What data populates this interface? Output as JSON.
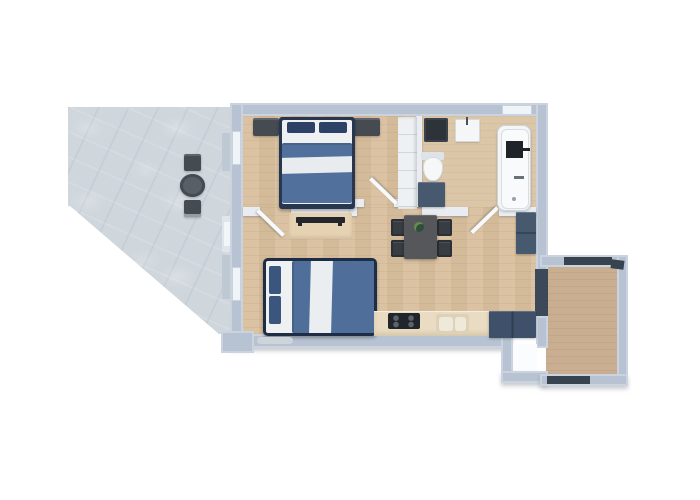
{
  "scene": {
    "kind": "3d-apartment-floor-plan",
    "background": "#ffffff",
    "visible_text": "none"
  },
  "palette": {
    "exterior_wall": "#b7c3d2",
    "interior_wall": "#e9edf1",
    "wood_floor": "#d8bf9e",
    "bathroom_floor": "#dcc6a8",
    "balcony_floor": "#c9ae92",
    "terrace_stone": "#cfd6dc",
    "bed_frame_navy": "#1f2d44",
    "duvet_blue": "#4f6f9a",
    "linen_white": "#eef0f2",
    "pillow_navy": "#2c4165",
    "dark_furniture": "#464b52",
    "blue_gray_cabinet": "#47596e",
    "appliance_dark": "#2e333a",
    "fixture_white": "#f4f6f8",
    "railing_dark": "#37434f"
  },
  "rooms": {
    "terrace": {
      "label": "Terrace with stone tiles"
    },
    "bedroom": {
      "label": "Bedroom with double bed"
    },
    "bathroom": {
      "label": "Bathroom"
    },
    "living": {
      "label": "Living room with bed, dining set and kitchen"
    },
    "balcony": {
      "label": "Balcony with wood deck"
    }
  },
  "furniture": {
    "terrace_table": {
      "label": "Round bistro table"
    },
    "terrace_chair_top": {
      "label": "Terrace chair (top)"
    },
    "terrace_chair_bottom": {
      "label": "Terrace chair (bottom)"
    },
    "bed1": {
      "label": "Double bed with blue duvet and white band"
    },
    "nightstand_left": {
      "label": "Nightstand left"
    },
    "nightstand_right": {
      "label": "Nightstand right"
    },
    "wardrobe": {
      "label": "White wardrobe"
    },
    "tv_console": {
      "label": "Low console with TV"
    },
    "bed2": {
      "label": "Double bed in living area"
    },
    "dining_table": {
      "label": "Dining table with plant"
    },
    "dining_chairs": {
      "label": "Four dining chairs"
    },
    "side_cabinet": {
      "label": "Cabinet at right wall"
    },
    "kitchen_counter": {
      "label": "Kitchen counter"
    },
    "cooktop": {
      "label": "Cooktop with four burners"
    },
    "kitchen_sink": {
      "label": "Double kitchen sink"
    },
    "kitchen_cabinet": {
      "label": "Dark kitchen cabinet"
    },
    "washing_machine": {
      "label": "Washing machine"
    },
    "bath_sink": {
      "label": "Wash basin"
    },
    "toilet": {
      "label": "Toilet"
    },
    "vanity": {
      "label": "Bathroom vanity"
    },
    "bathtub": {
      "label": "Bathtub"
    },
    "entry_recess": {
      "label": "Entry door recess"
    },
    "balcony_door": {
      "label": "Balcony door"
    },
    "doormat": {
      "label": "Mat"
    }
  }
}
